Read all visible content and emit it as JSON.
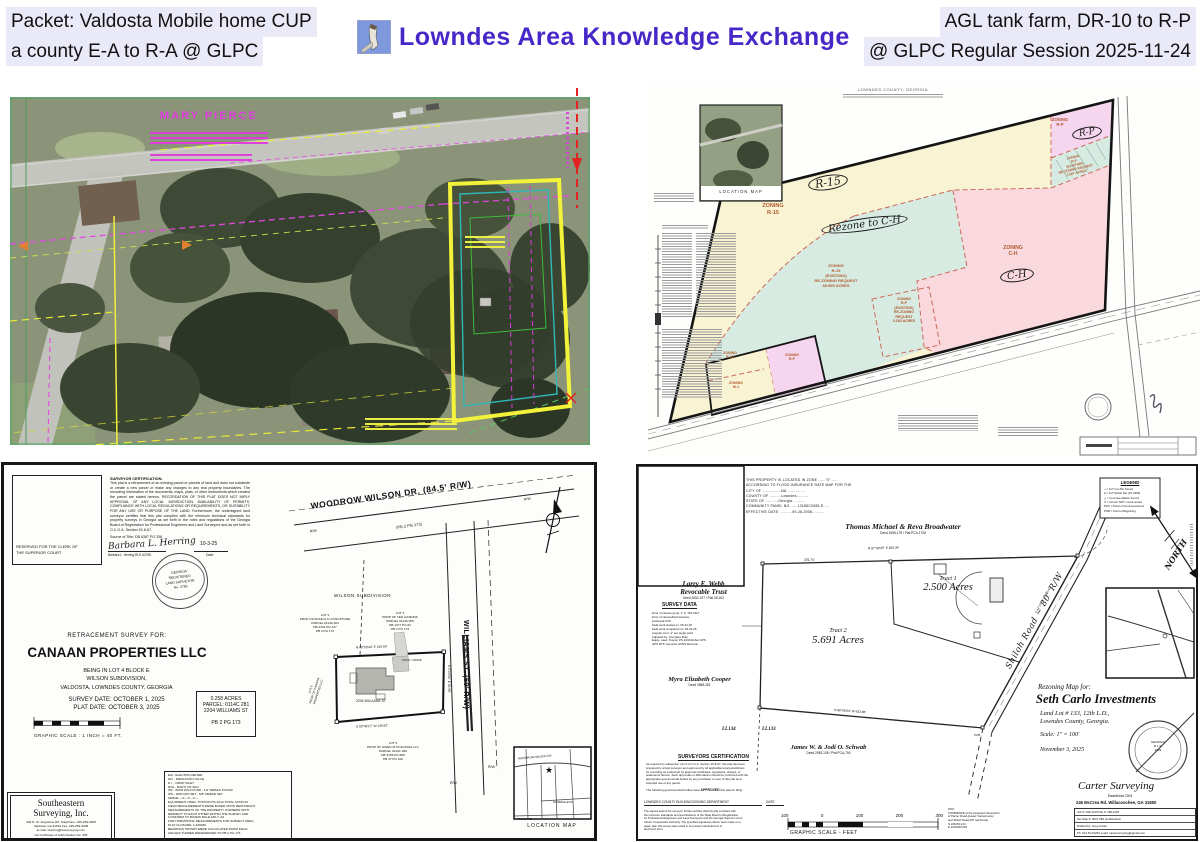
{
  "header": {
    "left_line1": "Packet: Valdosta Mobile home CUP",
    "left_line2": "a county E-A to R-A @ GLPC",
    "brand": "Lowndes Area Knowledge Exchange",
    "right_line1": "AGL tank farm, DR-10 to R-P",
    "right_line2": "@ GLPC Regular Session 2025-11-24",
    "brand_color": "#4727c8",
    "highlight_color": "#e9e9f8"
  },
  "aerial": {
    "owner": "MARY PIERCE"
  },
  "zoning": {
    "sheet_header": "LOWNDES COUNTY, GEORGIA",
    "location_map_caption": "LOCATION MAP",
    "colors": {
      "cream": "#f8f3d3",
      "teal": "#d7ebe2",
      "pink": "#f9d9de",
      "lavender": "#f5d6ee"
    },
    "labels": {
      "r15_zone": "ZONING\nR-15",
      "r15_circle": "R-15",
      "rezone_note": "Rezone to C-H",
      "teal_note": "ZONING\nR-15\n(EXISTING)\nRE-ZONING REQUEST\n38.909 ACRES",
      "ch_zone": "ZONING\nC-H",
      "ch_circle": "C-H",
      "rp_zone": "ZONING\nR-P",
      "rp_circle": "R-P",
      "rp_strip_note": "ZONING\nR-P\n(EXISTING)\nRE-ZONING REQUEST\n3.567 ACRES",
      "rp_mid_note": "ZONING\nR-P\n(EXISTING)\nRE-ZONING\nREQUEST\n3.260 ACRES",
      "small_r15": "ZONING\nR-15",
      "small_rp": "ZONING\nR-P",
      "small_m1": "ZONING\nM-1"
    }
  },
  "plat1": {
    "clerk_box": "RESERVED FOR THE CLERK OF THE SUPERIOR COURT",
    "cert_title": "SURVEYOR CERTIFICATION:",
    "cert_body": "This plat is a retracement of an existing parcel or parcels of land and does not subdivide or create a new parcel or make any changes to any real property boundaries. The recording information of the documents, maps, plats, or other instruments which created the parcel are stated hereon. RECORDATION OF THIS PLAT DOES NOT IMPLY APPROVAL OF ANY LOCAL JURISDICTION, AVAILABILITY OF PERMITS, COMPLIANCE WITH LOCAL REGULATIONS OR REQUIREMENTS, OR SUITABILITY FOR ANY USE OR PURPOSE OF THE LAND. Furthermore, the undersigned land surveyor certifies that this plat complies with the minimum technical standards for property surveys in Georgia as set forth in the rules and regulations of the Georgia Board of Registration for Professional Engineers and Land Surveyors and as set forth in O.C.G.A. Section 15-6-67.",
    "source_of_title": "Source of Title: DB 6387 PG 338",
    "signature": "Barbara L. Herring",
    "signature_name": "Barbara L. Herring  RLS #2765",
    "sig_date": "10-3-25",
    "date_label": "Date",
    "seal_text": "GEORGIA\nREGISTERED\nLAND SURVEYOR\nNo. 2765",
    "survey_for": "RETRACEMENT SURVEY FOR:",
    "client": "CANAAN PROPERTIES LLC",
    "desc": [
      "BEING IN LOT 4 BLOCK E",
      "WILSON SUBDIVISION,",
      "VALDOSTA, LOWNDES COUNTY, GEORGIA"
    ],
    "survey_date": "SURVEY DATE:  OCTOBER 1, 2025",
    "plat_date": "PLAT DATE:  OCTOBER 3, 2025",
    "scale_label": "GRAPHIC SCALE : 1 INCH = 40  FT.",
    "parcel_box": [
      "0.258 ACRES",
      "PARCEL: 0114C 281",
      "2204 WILLIAMS ST",
      "PB 2 PG 173"
    ],
    "legend_lines": [
      "EM  -  ELECTRIC METER",
      "WV  -  IRRIGATION VALVE",
      "D.I.  -  DROP INLET",
      "R/W  -  RIGHT OF WAY",
      "IPF  -  IRON PIN FOUND  -  1/2\" REBAR FOUND",
      "IPS  -  IRON PIN SET  -  5/8\" REBAR SET",
      "FENCE  ---X---X---X---",
      "EQUIPMENT USED: TOPCON PS-101A TOTAL STATION",
      "FIELD MEASUREMENTS WERE BASED UPON REDUNDANT",
      "MEASUREMENTS OF THE PROPERTY CORNERS WITH",
      "RESPECT TO EACH OTHER WITHIN THE SURVEY AND",
      "CONFORM TO BOARD RULE 180-7-.02",
      "FOR HORIZONTAL MEASUREMENTS FOR SUBJECT AREA,",
      "PLAT CLOSURE: 1:249939",
      "BEARINGS SHOWN WERE CALCULATED FROM FIELD",
      "ANGLES TURNED REFERENCED TO PB 2 PG 173"
    ],
    "firm_name1": "Southeastern",
    "firm_name2": "Surveying, Inc.",
    "firm_lines": [
      "403 N. St. Augustine Rd.    Telephone: 229-259-9405",
      "Valdosta, GA  31601                  Fax: 229-259-9408",
      "E-mail: sherring@sesurveying.com",
      "GA Certificate of Authorization No. 985"
    ],
    "road1": "WOODROW WILSON DR. (84.5' R/W)",
    "road1_ref": "(PB 2 PG 173)",
    "road2": "WILLIAMS ST. (60' R/W)",
    "subdivision": "WILSON SUBDIVISION",
    "rw": "R/W",
    "lot2": "LOT 2\nPROP OF BASILIA A LIVINGSTONE\nPARCEL 0114A 004\nDB 2334 PG 327\nPB 2 PG 173",
    "lot3": "LOT 3\nPROP OF TED GASKINS\nPARCEL 0114A 005\nDB 1377 PG 82\nPB 2 PG 173",
    "lot5": "LOT 5\nPROP OF GWEN W HOLDINGS LLC\nPARCEL 0114C 280\nDB 3156 PG 888\nPB 37 PG 100",
    "lot4_side": "LOT 4\nPROP OF CANAAN PROPERTIES LLC",
    "house_number": "2204 WILLIAMS ST",
    "conc_drive": "CONC. DRIVE",
    "bearing_top": "N 89°53'44\" E   149.59'",
    "bearing_bottom": "S 89°46'17\" W   149.62'",
    "bearing_right": "S 0°24'51\" E  59.98'",
    "location_map_caption": "LOCATION MAP",
    "inset_streets": [
      "WOODROW WILSON DR",
      "ROSEDALE PL",
      "PARK AVE"
    ]
  },
  "plat2": {
    "flood_lines": [
      "THIS PROPERTY IS LOCATED IN ZONE ......\"X\"......",
      "ACCORDING TO FLOOD INSURANCE RATE MAP FOR THE",
      "CITY OF ................NA................",
      "COUNTY OF ..........Lowndes..........",
      "STATE OF ...........Georgia...........",
      "COMMUNITY PANEL NO. .....13185C0085 E.....",
      "EFFECTIVE DATE: ..........09-26-2008.........."
    ],
    "owner_north": "Thomas Michael & Reva Broadwater",
    "owner_north_deed": "Deed 3455-178  /  Plat PCA-1708",
    "owner_west1": "Larry E. Webb",
    "owner_west2": "Revocable Trust",
    "owner_west_deed": "Deed 2652-197  /  Plat 35-202",
    "survey_data_title": "SURVEY DATA",
    "survey_data_lines": [
      "Error of closure (pos):  1' in \"NO.ADJ\"",
      "Error of closure/field traverse:",
      "   positional 0.05'",
      "Field work started on:  05-31-25",
      "Field work completed on:  05-31-25",
      "Angular error:  1\" per angle point",
      "Adjusted by:  Compass Rule",
      "Equip. used:  Topcon PS-103A Robot GPS",
      "GPS RTK:  Geomax GNSS Receiver"
    ],
    "owner_sw": "Myra Elizabeth Cooper",
    "owner_sw_deed": "Deed 0588-281",
    "ll_left": "LL134",
    "ll_right": "LL133",
    "owner_south": "James W. & Jodi O. Schwab",
    "owner_south_deed": "Deed 2983-108  /  Plat PCA-790",
    "tract1_name": "Tract 1",
    "tract1_acres": "2.500 Acres",
    "tract2_name": "Tract 2",
    "tract2_acres": "5.691 Acres",
    "road_label": "Shiloh Road ~ 80' R/W",
    "bearing_north": "N 87°40'35\" E   869.34'",
    "dist_north": "376.74'",
    "bearing_south": "N 88°59'04\" W   833.86'",
    "bearing_road": "S 43°17'25\" W   510.41'",
    "pob": "POB",
    "legend_title": "LEGEND",
    "legend_lines": [
      "□  =  1/2\" Iron Pin Found",
      "●  =  1/2\" Rebar Set (LS 2969)",
      "△  =  Concrete Marker Found",
      "✕  =  Corner NOT monumented",
      "POC = Point of Commencement",
      "POB = Point of Beginning"
    ],
    "cert_title": "SURVEYORS  CERTIFICATION",
    "cert_lines": [
      "As required by subsection (d) of O.C.G.A. Section 15-6-67, this plat has been",
      "prepared by a land surveyor and approved by all applicable local jurisdictions",
      "for recording as evidenced by approval certificates, signatures, stamps, or",
      "statements hereon. Such approvals or affirmations should be confirmed with the",
      "appropriate governmental bodies by any purchaser or user of this plat as to",
      "intended use of any parcel."
    ],
    "approved_pre": "The following governmental bodies have",
    "approved_word": "APPROVED",
    "approved_post": "this plat for filing:",
    "dept_line": "LOWNDES COUNTY BUILDING/ZONING DEPARTMENT",
    "dept_date": "DATE",
    "dept_note_lines": [
      "The signed seal of the surveyor further certifies that this plat complies with",
      "the minimum standards and specifications of the State Board of Registration",
      "for Professional Engineers and Land Surveyors and the Georgia Superior Court",
      "Clerks' Cooperative Authority. The specified signatures above were made on a",
      "paper plat; this survey also exists in its present identical form in",
      "electronic form."
    ],
    "scale_ticks": [
      "100",
      "0",
      "100",
      "200",
      "300"
    ],
    "scale_caption": "GRAPHIC SCALE  -  FEET",
    "poc_lines": [
      "POC:",
      "COMMENCE at the projected intersection",
      "of Parker Road (paved, hacked axle)",
      "and Shiloh Road (PK nail found)",
      "N 346150.213",
      "E 2534034.594"
    ],
    "map_for": "Rezoning Map for:",
    "client": "Seth Carlo Investments",
    "client_desc1": "Land Lot # 133, 12th L.D.,",
    "client_desc2": "Lowndes County, Georgia.",
    "scale_note": "Scale: 1\" = 100'",
    "map_date": "November 3, 2025",
    "firm": "Carter Surveying",
    "firm_sub": "Established 2004",
    "firm_addr": "246 McCrea Rd.  Willacoochee, GA 31650",
    "firm_rows": [
      "Job #:  298-1125            File #:  298-1125",
      "Tax Map #:  0021 059 (subdivided)",
      "Drafted by:  Greg Carter",
      "Ph: 912.514.5252   email: cartersurveying@gmail.com"
    ],
    "seal_text": "GEORGIA\nR.L.S.\n2969",
    "north_label": "NORTH"
  }
}
